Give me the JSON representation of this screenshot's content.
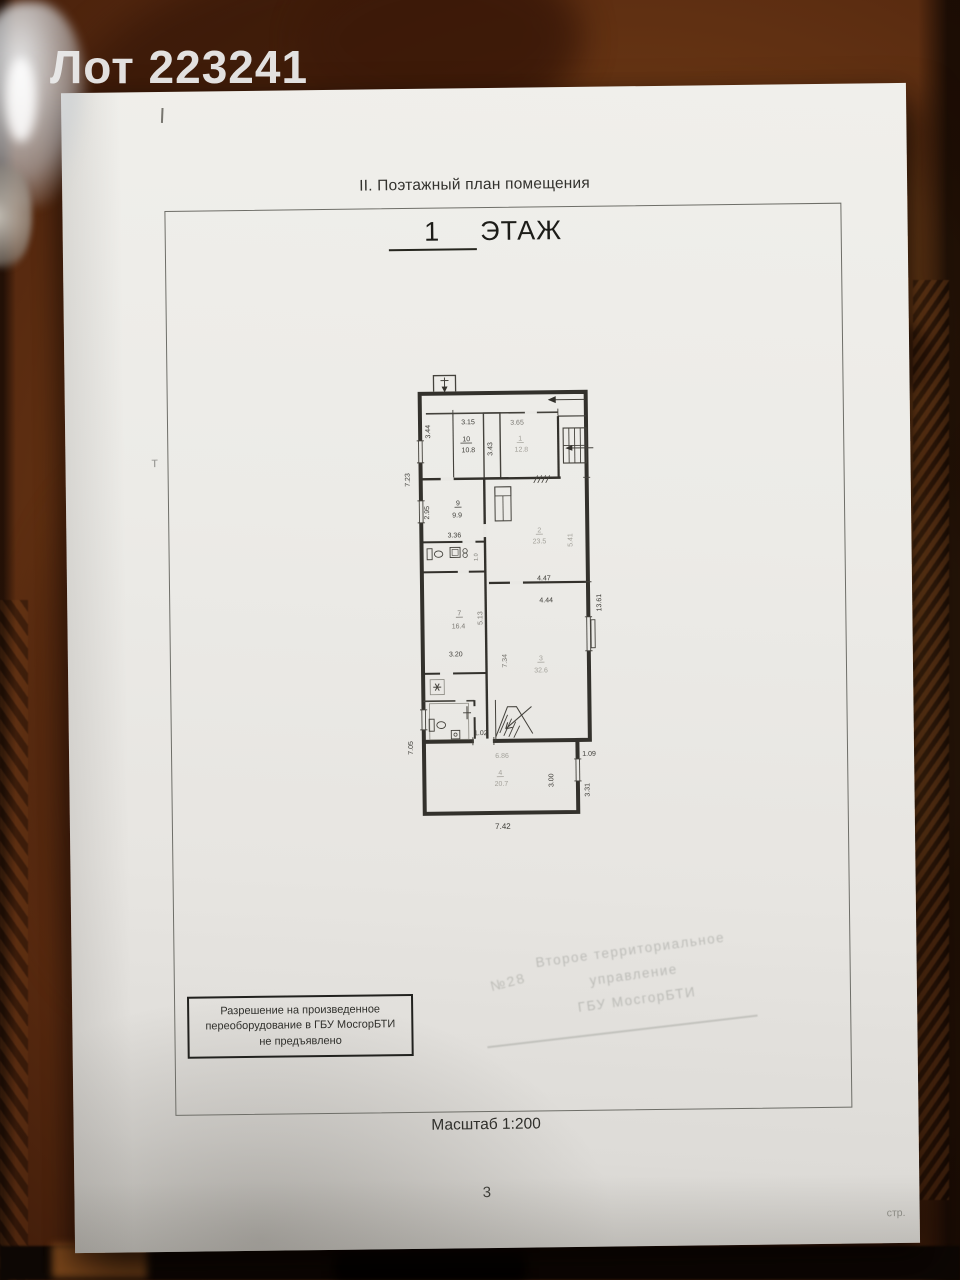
{
  "watermark": "Лот 223241",
  "document": {
    "section_title": "II. Поэтажный план помещения",
    "floor_number": "1",
    "floor_label": "ЭТАЖ",
    "scale_note": "Масштаб 1:200",
    "page_number": "3",
    "page_suffix": "стр.",
    "pencil_mark": "т",
    "permission_stamp": {
      "line1": "Разрешение на произведенное",
      "line2": "переоборудование в ГБУ МосгорБТИ",
      "line3": "не предъявлено"
    },
    "faint_stamp": {
      "line1": "Второе территориальное",
      "line2": "управление",
      "line3": "ГБУ МосгорБТИ",
      "number": "№28"
    }
  },
  "plan": {
    "rooms": [
      {
        "number": "1",
        "area_m2": "12.8"
      },
      {
        "number": "2",
        "area_m2": "23.5"
      },
      {
        "number": "3",
        "area_m2": "32.6"
      },
      {
        "number": "4",
        "area_m2": "20.7"
      },
      {
        "number": "7",
        "area_m2": "16.4"
      },
      {
        "number": "9",
        "area_m2": "9.9"
      },
      {
        "number": "10",
        "area_m2": "10.8"
      }
    ],
    "labels": [
      {
        "t": "3.15",
        "x": 471,
        "y": 424,
        "c": "d"
      },
      {
        "t": "3.65",
        "x": 520,
        "y": 425,
        "c": "m"
      },
      {
        "t": "3.44",
        "x": 433,
        "y": 431,
        "r": -90,
        "c": "d"
      },
      {
        "t": "10",
        "x": 469,
        "y": 441,
        "c": "d",
        "u": 1
      },
      {
        "t": "10.8",
        "x": 471,
        "y": 452,
        "c": "d"
      },
      {
        "t": "3.43",
        "x": 495,
        "y": 449,
        "r": -90,
        "c": "d"
      },
      {
        "t": "1",
        "x": 523,
        "y": 441,
        "c": "f",
        "u": 1
      },
      {
        "t": "12.8",
        "x": 524,
        "y": 452,
        "c": "f"
      },
      {
        "t": "7.23",
        "x": 412,
        "y": 479,
        "r": -90,
        "c": "d"
      },
      {
        "t": "2.95",
        "x": 431,
        "y": 512,
        "r": -90,
        "c": "d"
      },
      {
        "t": "9",
        "x": 460,
        "y": 505,
        "c": "d",
        "u": 1
      },
      {
        "t": "9.9",
        "x": 459,
        "y": 517,
        "c": "d"
      },
      {
        "t": "2",
        "x": 541,
        "y": 533,
        "c": "f",
        "u": 1
      },
      {
        "t": "23.5",
        "x": 541,
        "y": 544,
        "c": "f"
      },
      {
        "t": "3.36",
        "x": 456,
        "y": 537,
        "c": "d"
      },
      {
        "t": "5.41",
        "x": 574,
        "y": 541,
        "r": -90,
        "c": "f"
      },
      {
        "t": "1.0",
        "x": 479,
        "y": 557,
        "r": -90,
        "c": "m",
        "s": 5.5
      },
      {
        "t": "4.47",
        "x": 545,
        "y": 581,
        "c": "d"
      },
      {
        "t": "4.44",
        "x": 547,
        "y": 603,
        "c": "d"
      },
      {
        "t": "13.61",
        "x": 602,
        "y": 604,
        "r": -90,
        "c": "d"
      },
      {
        "t": "5.13",
        "x": 483,
        "y": 618,
        "r": -90,
        "c": "m"
      },
      {
        "t": "7",
        "x": 460,
        "y": 615,
        "c": "m",
        "u": 1
      },
      {
        "t": "16.4",
        "x": 459,
        "y": 628,
        "c": "m"
      },
      {
        "t": "3.20",
        "x": 456,
        "y": 656,
        "c": "d"
      },
      {
        "t": "7.34",
        "x": 507,
        "y": 661,
        "r": -90,
        "c": "m"
      },
      {
        "t": "3",
        "x": 541,
        "y": 661,
        "c": "f",
        "u": 1
      },
      {
        "t": "32.6",
        "x": 541,
        "y": 673,
        "c": "f"
      },
      {
        "t": "7.05",
        "x": 412,
        "y": 747,
        "r": -90,
        "c": "d"
      },
      {
        "t": "1.02",
        "x": 480,
        "y": 735,
        "c": "d"
      },
      {
        "t": "6.86",
        "x": 501,
        "y": 758,
        "c": "f"
      },
      {
        "t": "1.09",
        "x": 588,
        "y": 757,
        "c": "d"
      },
      {
        "t": "4",
        "x": 499,
        "y": 775,
        "c": "f",
        "u": 1
      },
      {
        "t": "20.7",
        "x": 500,
        "y": 786,
        "c": "f"
      },
      {
        "t": "3.00",
        "x": 552,
        "y": 781,
        "r": -90,
        "c": "d"
      },
      {
        "t": "3.31",
        "x": 588,
        "y": 791,
        "r": -90,
        "c": "d"
      },
      {
        "t": "7.42",
        "x": 501,
        "y": 829,
        "c": "d",
        "s": 8
      }
    ]
  },
  "colors": {
    "paper": "#eae8e4",
    "wood": "#6b3815",
    "ink": "#33312c",
    "faint_ink": "#a3a19a",
    "watermark_text": "#ebebeb"
  }
}
